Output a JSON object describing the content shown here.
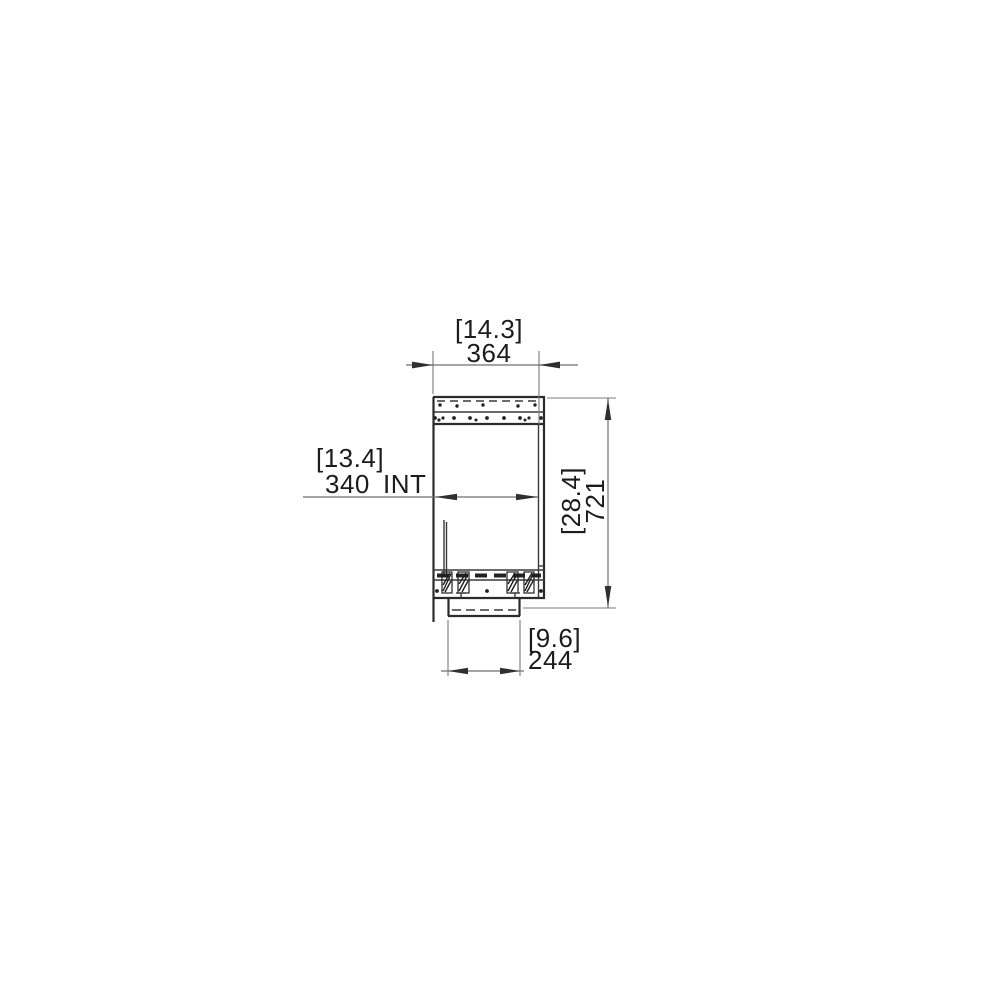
{
  "page": {
    "background_color": "#ffffff",
    "drawing_type": "technical-dimension-drawing-side-section"
  },
  "drawing": {
    "part_line_color": "#2b2b2b",
    "dimension_line_color": "#6f6f6f",
    "text_color": "#1c1c1c",
    "dimensions": {
      "overall_width": {
        "bracket": "[14.3]",
        "value": "364"
      },
      "internal_width": {
        "bracket": "[13.4]",
        "value": "340",
        "suffix": "INT"
      },
      "overall_height": {
        "bracket": "[28.4]",
        "value": "721"
      },
      "base_width": {
        "bracket": "[9.6]",
        "value": "244"
      }
    }
  }
}
